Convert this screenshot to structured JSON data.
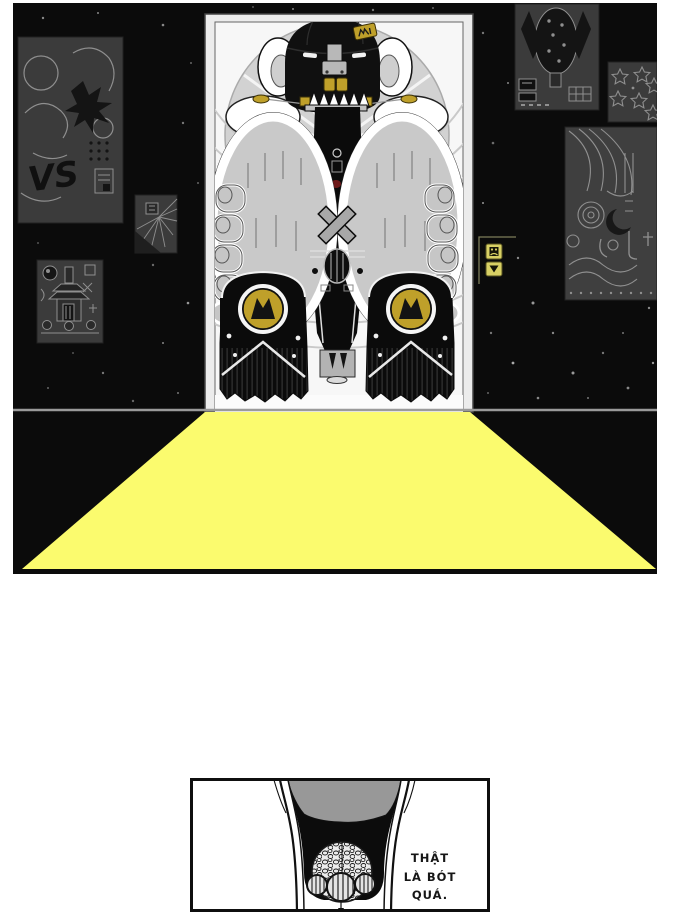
{
  "page": {
    "kind": "comic-page",
    "background_color": "#ffffff"
  },
  "panel1": {
    "description": "giant-figure-seated-in-elevator-dark-hall-with-posters-and-light-spill",
    "colors": {
      "room": "#0b0b0b",
      "light_beam": "#fbfb6e",
      "gold": "#bfa02a",
      "elevator_button": "#d8d064",
      "poster_background": "#3b3b3b",
      "poster_line": "#8f8f8f",
      "knee_gray": "#c9c9c9"
    },
    "vs_poster": {
      "label": "VS"
    },
    "call_buttons": {
      "top_icon": "elevator-car-icon",
      "bottom_icon": "down-triangle-icon"
    }
  },
  "panel2": {
    "description": "close-up-of-giant-leg-and-toes",
    "caption": {
      "line1": "THẬT",
      "line2": "LÀ BÓT",
      "line3": "QUÁ."
    }
  }
}
